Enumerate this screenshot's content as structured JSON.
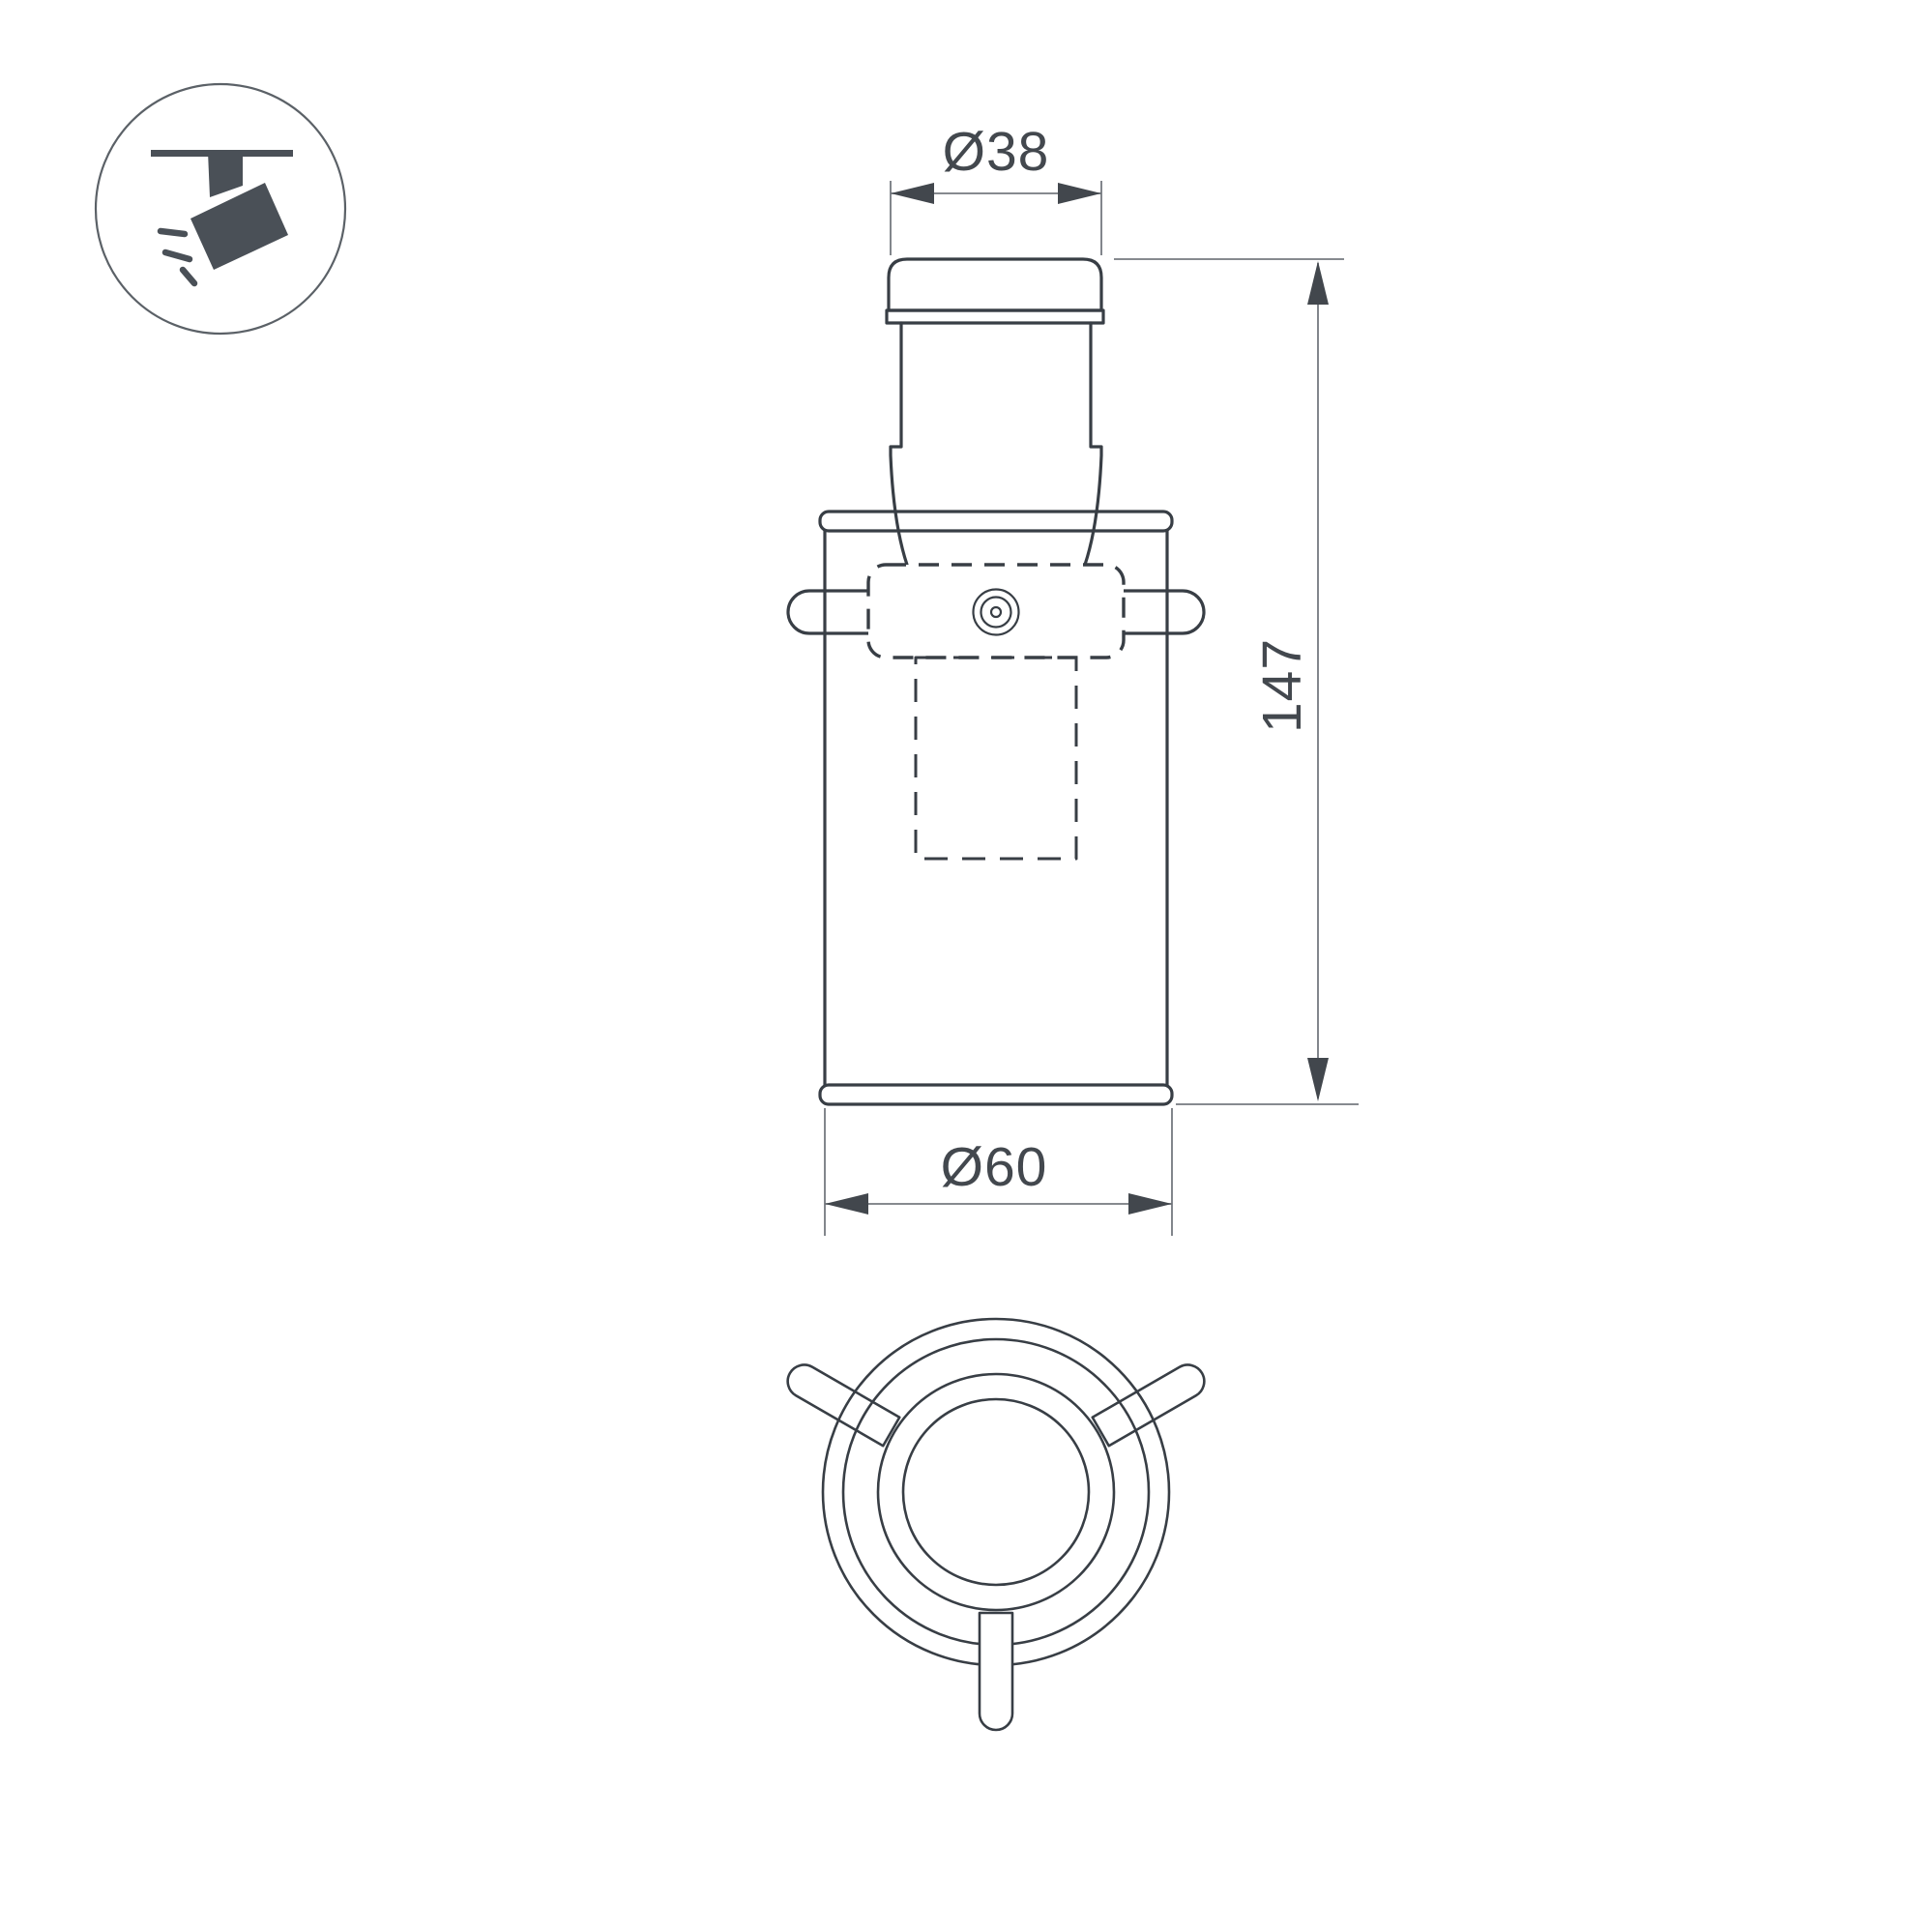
{
  "title": "luminaire-dimension-drawing",
  "icon": {
    "name": "track-spotlight-icon",
    "description": "ceiling track with tilted spotlight and light rays"
  },
  "dimensions": {
    "top_diameter_label": "Ø38",
    "top_diameter_value": 38,
    "height_label": "147",
    "height_value": 147,
    "bottom_diameter_label": "Ø60",
    "bottom_diameter_value": 60
  },
  "views": {
    "front_view": "front elevation of cylindrical track luminaire",
    "bottom_view": "bottom view with three locking pins"
  },
  "colors": {
    "background": "#ffffff",
    "outline_stroke": "#383e45",
    "icon_fill": "#4a5057",
    "dimension_line": "#74797f",
    "arrow_fill": "#42474d",
    "text": "#43484e"
  }
}
